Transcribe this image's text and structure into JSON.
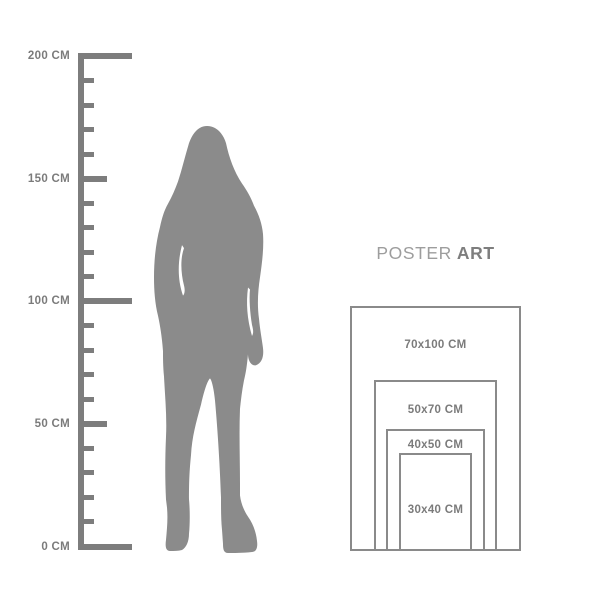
{
  "page": {
    "background": "#ffffff"
  },
  "ruler": {
    "unit": "CM",
    "min_cm": 0,
    "max_cm": 200,
    "tick_step_cm": 10,
    "labeled_ticks": [
      {
        "cm": 200,
        "label": "200 CM"
      },
      {
        "cm": 150,
        "label": "150 CM"
      },
      {
        "cm": 100,
        "label": "100 CM"
      },
      {
        "cm": 50,
        "label": "50 CM"
      },
      {
        "cm": 0,
        "label": "0 CM"
      }
    ],
    "color": "#7d7d7d",
    "label_color": "#7b7b7b"
  },
  "figure": {
    "name": "standing-woman-silhouette",
    "color": "#8b8b8b"
  },
  "size_guide": {
    "title": {
      "word1": "POSTER",
      "word2": "ART"
    },
    "title_colors": {
      "word1": "#9d9d9d",
      "word2": "#7e7e7e"
    },
    "border_color": "#8a8a8a",
    "label_color": "#7b7b7b",
    "sizes": [
      {
        "label": "70x100 CM",
        "width_cm": 70,
        "height_cm": 100
      },
      {
        "label": "50x70 CM",
        "width_cm": 50,
        "height_cm": 70
      },
      {
        "label": "40x50 CM",
        "width_cm": 40,
        "height_cm": 50
      },
      {
        "label": "30x40 CM",
        "width_cm": 30,
        "height_cm": 40
      }
    ]
  }
}
